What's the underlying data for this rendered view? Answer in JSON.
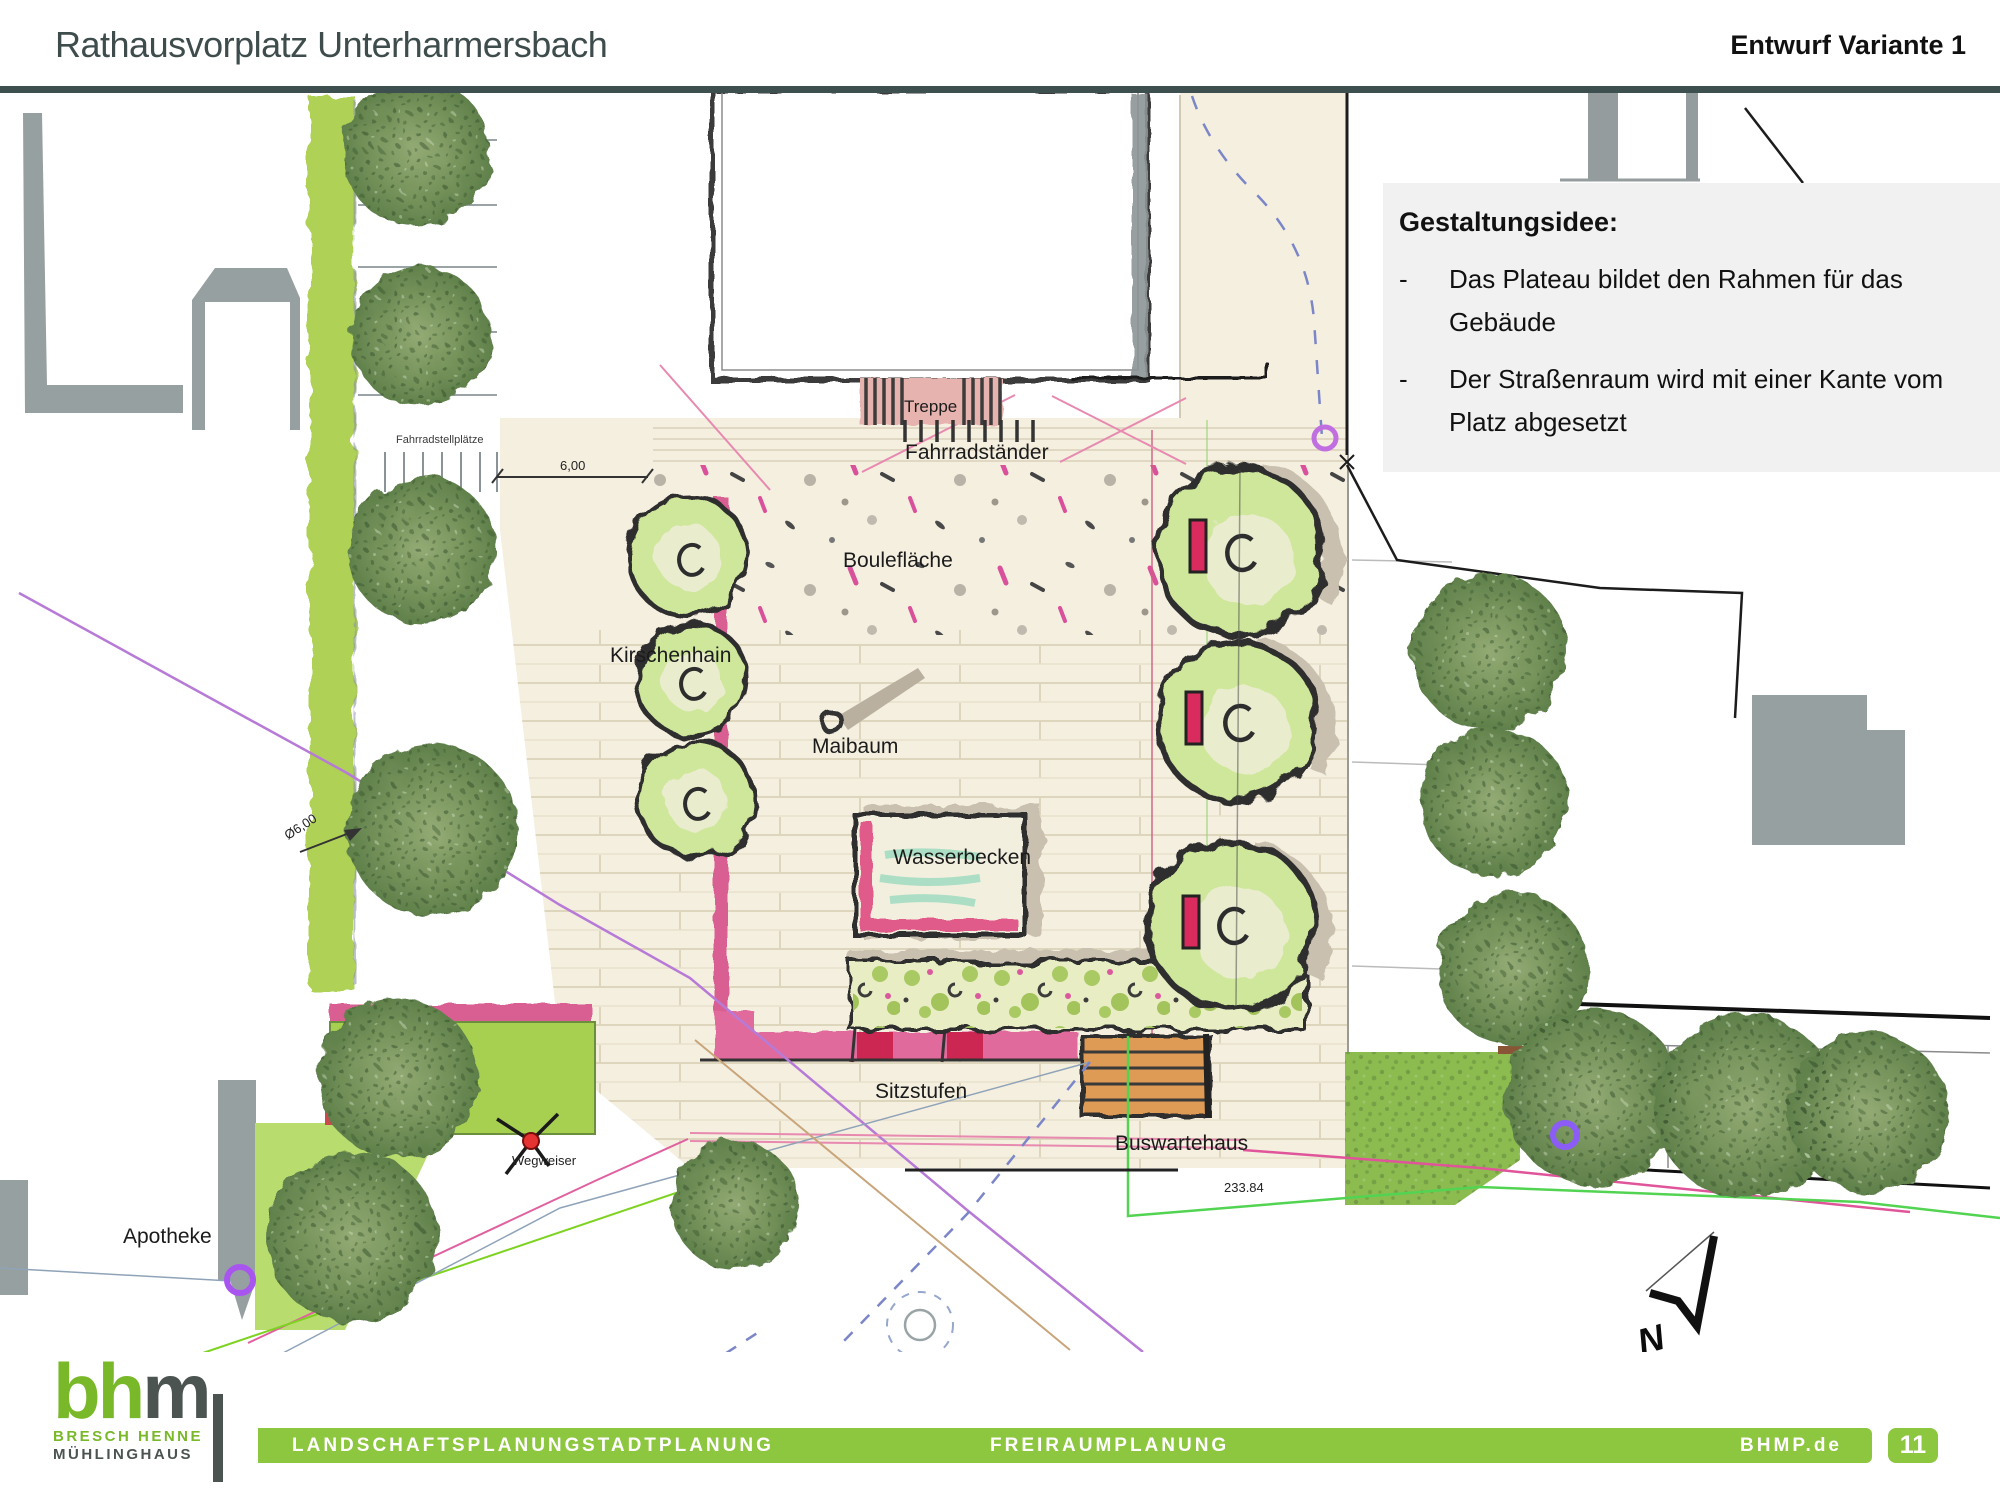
{
  "header": {
    "title": "Rathausvorplatz Unterharmersbach",
    "variant": "Entwurf Variante 1"
  },
  "idea_box": {
    "title": "Gestaltungsidee:",
    "bullets": [
      {
        "marker": "-",
        "text": "Das Plateau bildet den Rahmen für das Gebäude"
      },
      {
        "marker": "-",
        "text": "Der Straßenraum  wird mit einer Kante vom Platz abgesetzt"
      }
    ]
  },
  "plan": {
    "labels": {
      "treppe": "Treppe",
      "fahrradstaender": "Fahrradständer",
      "fahrradstellplaetze": "Fahrradstellplätze",
      "bouleflaeche": "Boulefläche",
      "kirschenhain": "Kirschenhain",
      "maibaum": "Maibaum",
      "wasserbecken": "Wasserbecken",
      "sitzstufen": "Sitzstufen",
      "buswartehaus": "Buswartehaus",
      "wegweiser": "Wegweiser",
      "apotheke": "Apotheke"
    },
    "dimensions": {
      "width": "6,00",
      "diameter": "Ø6,00",
      "elevation": "233.84"
    },
    "north_label": "N"
  },
  "footer": {
    "logo": {
      "text_green": "bh",
      "text_dark": "m",
      "line1": "BRESCH HENNE",
      "line2": "MÜHLINGHAUS"
    },
    "services": [
      "LANDSCHAFTSPLANUNG",
      "STADTPLANUNG",
      "FREIRAUMPLANUNG"
    ],
    "website": "BHMP.de",
    "page": "11"
  },
  "colors": {
    "bar_green": "#8dc63f",
    "logo_green": "#79b829",
    "logo_dark": "#4b5450",
    "header_text": "#3e4c4c",
    "plaza_beige": "#f5efe0",
    "strip_green": "#aed157",
    "accent_pink": "#e0659c",
    "accent_orange": "#dd9b57",
    "water_green": "#9fdcc0",
    "line_purple": "#b77ad6",
    "line_magenta": "#e0559a",
    "line_green": "#52d452",
    "line_blue_dashed": "#7b86c8"
  }
}
